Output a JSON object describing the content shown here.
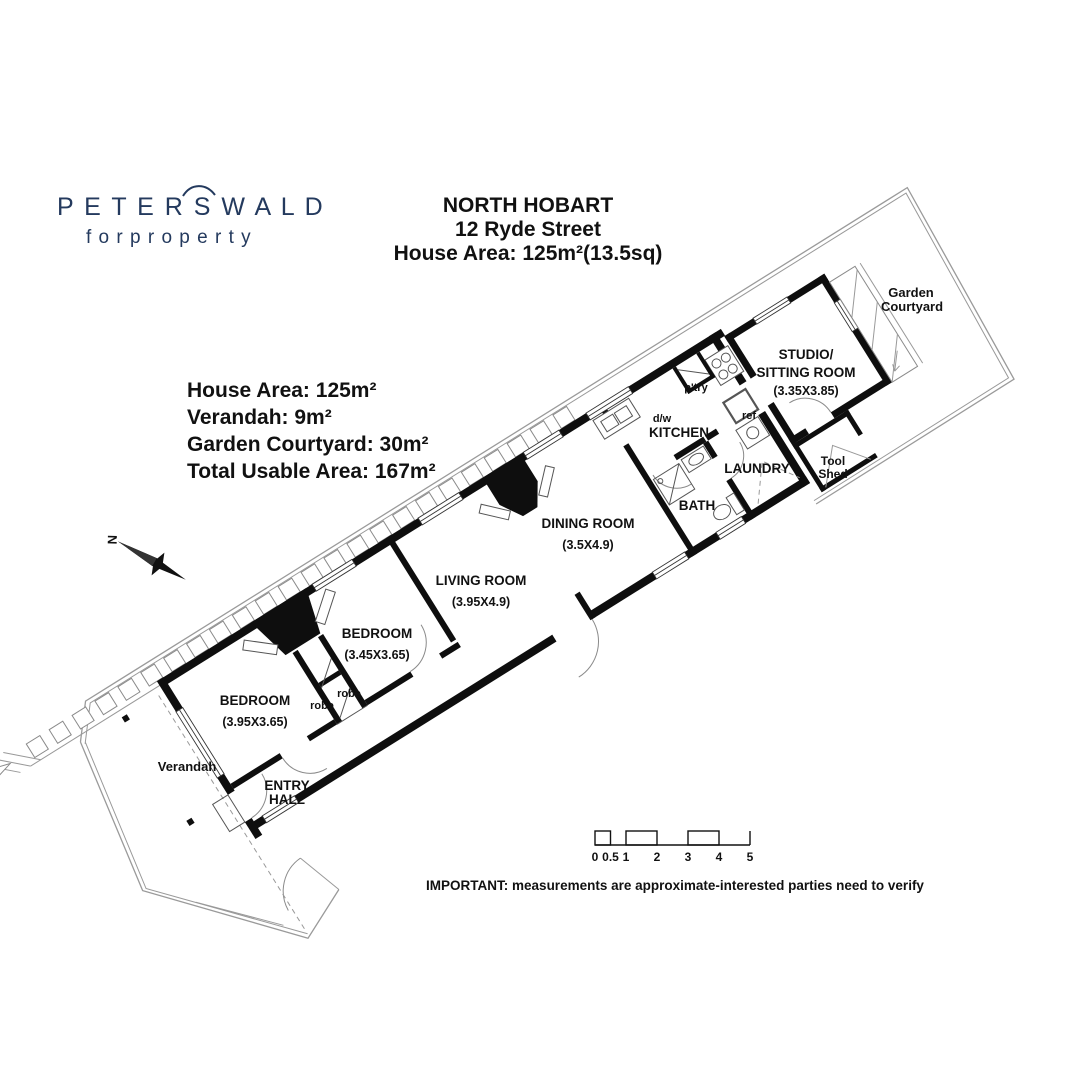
{
  "branding": {
    "wordmark": "P E T E R S W A L D",
    "tagline": "f o r   p r o p e r t y",
    "color": "#243a5e"
  },
  "header": {
    "suburb": "NORTH HOBART",
    "street": "12 Ryde Street",
    "area_line": "House Area: 125m²(13.5sq)"
  },
  "summary": {
    "house_area": "House Area: 125m²",
    "verandah": "Verandah: 9m²",
    "garden_courtyard": "Garden Courtyard: 30m²",
    "total": "Total Usable Area: 167m²"
  },
  "plan": {
    "rooms": {
      "bedroom1": {
        "name": "BEDROOM",
        "dims": "(3.95X3.65)"
      },
      "bedroom2": {
        "name": "BEDROOM",
        "dims": "(3.45X3.65)"
      },
      "living": {
        "name": "LIVING ROOM",
        "dims": "(3.95X4.9)"
      },
      "dining": {
        "name": "DINING ROOM",
        "dims": "(3.5X4.9)"
      },
      "kitchen": {
        "name": "KITCHEN"
      },
      "bath": {
        "name": "BATH"
      },
      "laundry": {
        "name": "LAUNDRY"
      },
      "studio": {
        "line1": "STUDIO/",
        "line2": "SITTING ROOM",
        "dims": "(3.35X3.85)"
      },
      "entry": {
        "line1": "ENTRY",
        "line2": "HALL"
      },
      "verandah": {
        "name": "Verandah"
      },
      "tool_shed": {
        "line1": "Tool",
        "line2": "Shed"
      },
      "garden_courtyard": {
        "line1": "Garden",
        "line2": "Courtyard"
      }
    },
    "fixtures": {
      "robe1": "robe",
      "robe2": "robe",
      "dw": "d/w",
      "pantry": "p'try",
      "ref": "ref"
    },
    "compass": {
      "north": "N"
    },
    "scale_bar": {
      "labels": [
        "0",
        "0.5",
        "1",
        "2",
        "3",
        "4",
        "5"
      ]
    },
    "disclaimer": "IMPORTANT: measurements are approximate-interested parties need to verify"
  }
}
